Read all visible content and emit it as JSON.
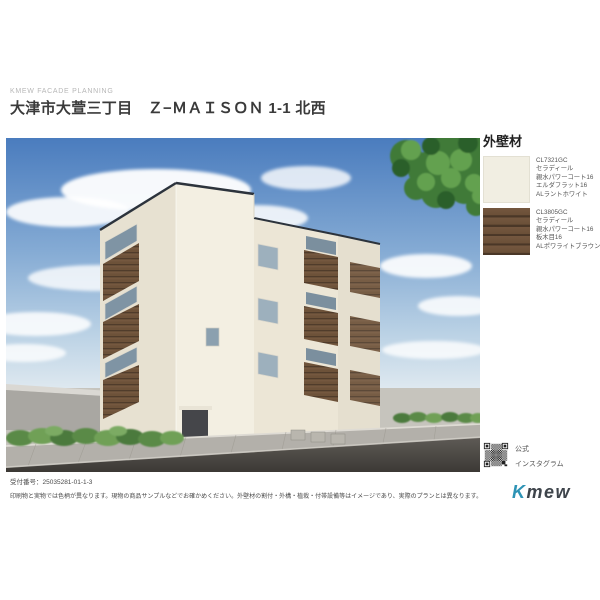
{
  "header": {
    "eyebrow": "KMEW FACADE PLANNING",
    "title": "大津市大萱三丁目　Ｚ−ＭＡＩＳＯＮ 1-1 北西"
  },
  "rendering": {
    "sky_color": "#4a7cbe",
    "building_wall_color": "#f3efe2",
    "accent_wood_color": "#6b5038",
    "road_color": "#45413c",
    "hedge_color": "#5a8a47"
  },
  "materials_panel": {
    "heading": "外壁材",
    "items": [
      {
        "code": "CL7321GC",
        "line1": "セラディール",
        "line2": "親水パワーコート16",
        "line3": "エルダフラット16",
        "line4": "ALラントホワイト",
        "swatch_color": "#f1eee2"
      },
      {
        "code": "CL3805GC",
        "line1": "セラディール",
        "line2": "親水パワーコート16",
        "line3": "板木目16",
        "line4": "ALポワライトブラウン",
        "swatch_color": "#6b5038"
      }
    ]
  },
  "social": {
    "label_line1": "公式",
    "label_line2": "インスタグラム"
  },
  "footer": {
    "receipt": "受付番号：25035281-01-1-3",
    "disclaimer": "印刷物と実物では色柄が異なります。現物の商品サンプルなどでお確かめください。外壁材の割付・外構・植栽・付帯設備等はイメージであり、実際のプランとは異なります。",
    "logo_k": "K",
    "logo_rest": "mew"
  }
}
